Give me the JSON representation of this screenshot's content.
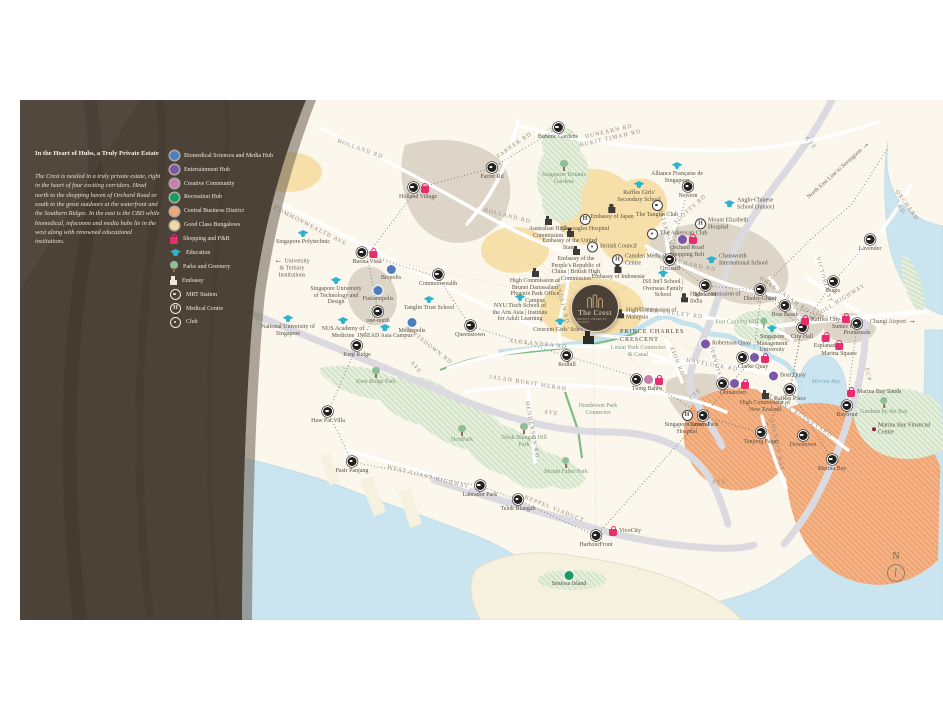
{
  "panel": {
    "title": "In the Heart of Hubs, a Truly Private Estate",
    "body": "The Crest is nestled in a truly private estate, right in the heart of four exciting corridors. Head north to the shopping haven of Orchard Road or south to the great outdoors at the waterfront and the Southern Ridges. In the east is the CBD while biomedical, infocomm and media hubs lie in the west along with renowned educational institutions.",
    "legend": [
      {
        "type": "hub-biomedical",
        "label": "Biomedical Sciences and Media Hub"
      },
      {
        "type": "hub-entertainment",
        "label": "Entertainment Hub"
      },
      {
        "type": "hub-creative",
        "label": "Creative Community"
      },
      {
        "type": "hub-recreation",
        "label": "Recreation Hub"
      },
      {
        "type": "hub-cbd",
        "label": "Central Business District"
      },
      {
        "type": "hub-gcb",
        "label": "Good Class Bungalows"
      },
      {
        "type": "shopping",
        "label": "Shopping and F&B"
      },
      {
        "type": "education",
        "label": "Education"
      },
      {
        "type": "park",
        "label": "Parks and Greenery"
      },
      {
        "type": "embassy",
        "label": "Embassy"
      },
      {
        "type": "mrt",
        "label": "MRT Station"
      },
      {
        "type": "medical",
        "label": "Medical Centre"
      },
      {
        "type": "club",
        "label": "Club"
      }
    ]
  },
  "crest": {
    "name": "The Crest",
    "tagline": "AT PRINCE CHARLES CRESCENT",
    "road": "PRINCE CHARLES\nCRESCENT"
  },
  "compass": {
    "label": "N"
  },
  "map": {
    "points": [
      {
        "x": 472,
        "y": 68,
        "icons": [
          "mrt"
        ],
        "label": "Farrer Rd"
      },
      {
        "x": 538,
        "y": 28,
        "icons": [
          "mrt"
        ],
        "label": "Botanic Gardens"
      },
      {
        "x": 668,
        "y": 87,
        "icons": [
          "mrt"
        ],
        "label": "Newton"
      },
      {
        "x": 398,
        "y": 88,
        "icons": [
          "mrt",
          "shopping"
        ],
        "label": "Holland Village"
      },
      {
        "x": 347,
        "y": 153,
        "icons": [
          "mrt",
          "shopping"
        ],
        "label": "Buona Vista"
      },
      {
        "x": 418,
        "y": 175,
        "icons": [
          "mrt"
        ],
        "label": "Commonwealth"
      },
      {
        "x": 358,
        "y": 212,
        "icons": [
          "mrt"
        ],
        "label": "one-north"
      },
      {
        "x": 337,
        "y": 246,
        "icons": [
          "mrt"
        ],
        "label": "Kent Ridge"
      },
      {
        "x": 308,
        "y": 312,
        "icons": [
          "mrt"
        ],
        "label": "Haw Par Villa"
      },
      {
        "x": 450,
        "y": 226,
        "icons": [
          "mrt"
        ],
        "label": "Queenstown"
      },
      {
        "x": 547,
        "y": 256,
        "icons": [
          "mrt"
        ],
        "label": "Redhill"
      },
      {
        "x": 627,
        "y": 280,
        "icons": [
          "mrt",
          "hub-creative",
          "shopping"
        ],
        "label": "Tiong Bahru"
      },
      {
        "x": 332,
        "y": 362,
        "icons": [
          "mrt"
        ],
        "label": "Pasir Panjang"
      },
      {
        "x": 460,
        "y": 386,
        "icons": [
          "mrt"
        ],
        "label": "Labrador Park"
      },
      {
        "x": 498,
        "y": 400,
        "icons": [
          "mrt"
        ],
        "label": "Telok Blangah"
      },
      {
        "x": 576,
        "y": 436,
        "icons": [
          "mrt"
        ],
        "label": "HarbourFront"
      },
      {
        "x": 594,
        "y": 431,
        "icons": [
          "shopping"
        ],
        "label": "VivoCity",
        "side": "r"
      },
      {
        "x": 650,
        "y": 160,
        "icons": [
          "mrt"
        ],
        "label": "Orchard"
      },
      {
        "x": 685,
        "y": 186,
        "icons": [
          "mrt"
        ],
        "label": "Somerset"
      },
      {
        "x": 740,
        "y": 190,
        "icons": [
          "mrt"
        ],
        "label": "Dhoby Ghaut"
      },
      {
        "x": 765,
        "y": 206,
        "icons": [
          "mrt"
        ],
        "label": "Bras Basah"
      },
      {
        "x": 813,
        "y": 182,
        "icons": [
          "mrt"
        ],
        "label": "Bugis"
      },
      {
        "x": 782,
        "y": 228,
        "icons": [
          "mrt"
        ],
        "label": "City Hall"
      },
      {
        "x": 837,
        "y": 224,
        "icons": [
          "mrt"
        ],
        "label": "Promenade"
      },
      {
        "x": 806,
        "y": 238,
        "icons": [
          "shopping"
        ],
        "label": "Esplanade"
      },
      {
        "x": 786,
        "y": 220,
        "icons": [
          "shopping"
        ],
        "label": "Raffles City",
        "side": "r"
      },
      {
        "x": 826,
        "y": 219,
        "icons": [
          "shopping"
        ],
        "label": "Suntec City"
      },
      {
        "x": 819,
        "y": 246,
        "icons": [
          "shopping"
        ],
        "label": "Marina Square"
      },
      {
        "x": 832,
        "y": 292,
        "icons": [
          "shopping"
        ],
        "label": "Marina Bay Sands",
        "side": "r"
      },
      {
        "x": 827,
        "y": 306,
        "icons": [
          "mrt"
        ],
        "label": "Bayfront"
      },
      {
        "x": 770,
        "y": 290,
        "icons": [
          "mrt"
        ],
        "label": "Raffles Place"
      },
      {
        "x": 783,
        "y": 336,
        "icons": [
          "mrt"
        ],
        "label": "Downtown"
      },
      {
        "x": 812,
        "y": 360,
        "icons": [
          "mrt"
        ],
        "label": "Marina Bay"
      },
      {
        "x": 741,
        "y": 333,
        "icons": [
          "mrt"
        ],
        "label": "Tanjong Pagar"
      },
      {
        "x": 683,
        "y": 316,
        "icons": [
          "mrt"
        ],
        "label": "Outram Park"
      },
      {
        "x": 713,
        "y": 284,
        "icons": [
          "mrt",
          "hub-entertainment",
          "shopping"
        ],
        "label": "Chinatown"
      },
      {
        "x": 733,
        "y": 258,
        "icons": [
          "mrt",
          "hub-entertainment",
          "shopping"
        ],
        "label": "Clarke Quay"
      },
      {
        "x": 850,
        "y": 140,
        "icons": [
          "mrt"
        ],
        "label": "Lavender"
      },
      {
        "x": 686,
        "y": 244,
        "icons": [
          "hub-entertainment"
        ],
        "label": "Robertson Quay",
        "side": "r"
      },
      {
        "x": 754,
        "y": 276,
        "icons": [
          "hub-entertainment"
        ],
        "label": "Boat Quay",
        "side": "r"
      },
      {
        "x": 667,
        "y": 140,
        "icons": [
          "hub-entertainment",
          "shopping"
        ],
        "label": "Orchard Road Shopping Belt"
      },
      {
        "x": 371,
        "y": 171,
        "icons": [
          "hub-biomedical"
        ],
        "label": "Biopolis"
      },
      {
        "x": 358,
        "y": 192,
        "icons": [
          "hub-biomedical"
        ],
        "label": "Fusionopolis"
      },
      {
        "x": 392,
        "y": 224,
        "icons": [
          "hub-biomedical"
        ],
        "label": "Mediapolis"
      },
      {
        "x": 549,
        "y": 477,
        "icons": [
          "hub-recreation"
        ],
        "label": "Sentosa Island"
      },
      {
        "x": 283,
        "y": 136,
        "icons": [
          "education"
        ],
        "label": "Singapore Polytechnic"
      },
      {
        "x": 316,
        "y": 183,
        "icons": [
          "education"
        ],
        "label": "Singapore University of Technology and Design"
      },
      {
        "x": 268,
        "y": 221,
        "icons": [
          "education"
        ],
        "label": "National University of Singapore"
      },
      {
        "x": 323,
        "y": 223,
        "icons": [
          "education"
        ],
        "label": "NUS Academy of Medicine"
      },
      {
        "x": 365,
        "y": 230,
        "icons": [
          "education"
        ],
        "label": "INSEAD Asia Campus"
      },
      {
        "x": 409,
        "y": 202,
        "icons": [
          "education"
        ],
        "label": "Tanglin Trust School"
      },
      {
        "x": 540,
        "y": 224,
        "icons": [
          "education"
        ],
        "label": "Crescent Girls' School"
      },
      {
        "x": 500,
        "y": 200,
        "icons": [
          "education"
        ],
        "label": "NYU Tisch School of the Arts Asia | Institute for Adult Learning"
      },
      {
        "x": 619,
        "y": 87,
        "icons": [
          "education"
        ],
        "label": "Raffles Girls' Secondary School"
      },
      {
        "x": 657,
        "y": 68,
        "icons": [
          "education"
        ],
        "label": "Alliance Française de Singapour"
      },
      {
        "x": 709,
        "y": 104,
        "icons": [
          "education"
        ],
        "label": "Anglo-Chinese School (Junior)",
        "side": "r"
      },
      {
        "x": 691,
        "y": 160,
        "icons": [
          "education"
        ],
        "label": "Chatsworth International School",
        "side": "r"
      },
      {
        "x": 643,
        "y": 176,
        "icons": [
          "education"
        ],
        "label": "ISS Int'l School | Overseas Family School"
      },
      {
        "x": 752,
        "y": 231,
        "icons": [
          "education"
        ],
        "label": "Singapore Management University"
      },
      {
        "x": 565,
        "y": 120,
        "icons": [
          "medical"
        ],
        "label": "Gleneagles Hospital"
      },
      {
        "x": 597,
        "y": 160,
        "icons": [
          "medical"
        ],
        "label": "Camden Medical Centre",
        "side": "r"
      },
      {
        "x": 680,
        "y": 124,
        "icons": [
          "medical"
        ],
        "label": "Mount Elizabeth Hospital",
        "side": "r"
      },
      {
        "x": 667,
        "y": 316,
        "icons": [
          "medical"
        ],
        "label": "Singapore General Hospital"
      },
      {
        "x": 637,
        "y": 106,
        "icons": [
          "club"
        ],
        "label": "The Tanglin Club"
      },
      {
        "x": 632,
        "y": 134,
        "icons": [
          "club"
        ],
        "label": "The American Club",
        "side": "r"
      },
      {
        "x": 572,
        "y": 147,
        "icons": [
          "club"
        ],
        "label": "British Council",
        "side": "r"
      },
      {
        "x": 528,
        "y": 122,
        "icons": [
          "embassy"
        ],
        "label": "Australian High Commission"
      },
      {
        "x": 550,
        "y": 134,
        "icons": [
          "embassy"
        ],
        "label": "Embassy of the United States"
      },
      {
        "x": 592,
        "y": 110,
        "icons": [
          "embassy"
        ],
        "label": "Embassy of Japan"
      },
      {
        "x": 556,
        "y": 152,
        "icons": [
          "embassy"
        ],
        "label": "Embassy of the People's Republic of China | British High Commission"
      },
      {
        "x": 515,
        "y": 174,
        "icons": [
          "embassy"
        ],
        "label": "High Commission of Brunei Darussalam"
      },
      {
        "x": 598,
        "y": 170,
        "icons": [
          "embassy"
        ],
        "label": "Embassy of Indonesia"
      },
      {
        "x": 666,
        "y": 198,
        "icons": [
          "embassy"
        ],
        "label": "High Commission of India",
        "side": "r"
      },
      {
        "x": 602,
        "y": 214,
        "icons": [
          "embassy"
        ],
        "label": "High Commission of Malaysia",
        "side": "r"
      },
      {
        "x": 745,
        "y": 296,
        "icons": [
          "embassy"
        ],
        "label": "High Commission of New Zealand"
      },
      {
        "x": 544,
        "y": 66,
        "icons": [
          "park"
        ],
        "label": "Singapore Botanic Gardens",
        "cls": "park"
      },
      {
        "x": 356,
        "y": 273,
        "icons": [
          "park"
        ],
        "label": "Kent Ridge Park",
        "cls": "park"
      },
      {
        "x": 442,
        "y": 331,
        "icons": [
          "park"
        ],
        "label": "HortPark",
        "cls": "park"
      },
      {
        "x": 504,
        "y": 329,
        "icons": [
          "park"
        ],
        "label": "Telok Blangah Hill Park",
        "cls": "park"
      },
      {
        "x": 546,
        "y": 363,
        "icons": [
          "park"
        ],
        "label": "Mount Faber Park",
        "cls": "park"
      },
      {
        "x": 743,
        "y": 223,
        "icons": [
          "park"
        ],
        "label": "Fort Canning Hill",
        "side": "l",
        "cls": "park"
      },
      {
        "x": 864,
        "y": 303,
        "icons": [
          "park"
        ],
        "label": "Gardens by the Bay",
        "cls": "park"
      },
      {
        "x": 857,
        "y": 329,
        "icons": [
          "poi"
        ],
        "label": "Marina Bay Financial Centre",
        "side": "r"
      },
      {
        "x": 515,
        "y": 196,
        "icons": [],
        "label": "Phoenix Park Office Campus"
      },
      {
        "x": 578,
        "y": 308,
        "icons": [],
        "label": "Henderson Park Connector",
        "cls": "park"
      },
      {
        "x": 618,
        "y": 250,
        "icons": [],
        "label": "Linear Park Connector & Canal",
        "cls": "park"
      },
      {
        "x": 806,
        "y": 284,
        "icons": [],
        "label": "Marina Bay",
        "cls": "water"
      }
    ],
    "roads": [
      {
        "x": 590,
        "y": 36,
        "r": -13,
        "label": "DUNEARN RD\nBUKIT TIMAH RD"
      },
      {
        "x": 495,
        "y": 46,
        "r": -35,
        "label": "FARRER RD"
      },
      {
        "x": 340,
        "y": 50,
        "r": 20,
        "label": "HOLLAND RD"
      },
      {
        "x": 487,
        "y": 117,
        "r": 14,
        "label": "HOLLAND RD"
      },
      {
        "x": 290,
        "y": 127,
        "r": 27,
        "label": "COMMONWEALTH AVE"
      },
      {
        "x": 408,
        "y": 246,
        "r": 38,
        "label": "PORTSDOWN RD"
      },
      {
        "x": 395,
        "y": 268,
        "r": 52,
        "label": "AYE"
      },
      {
        "x": 531,
        "y": 314,
        "r": 8,
        "label": "AYE"
      },
      {
        "x": 699,
        "y": 383,
        "r": 0,
        "label": "AYE"
      },
      {
        "x": 541,
        "y": 202,
        "r": 76,
        "label": "TANGLIN RD"
      },
      {
        "x": 646,
        "y": 134,
        "r": 74,
        "label": "PATERSON RD"
      },
      {
        "x": 671,
        "y": 110,
        "r": -42,
        "label": "SCOTTS RD"
      },
      {
        "x": 672,
        "y": 166,
        "r": 12,
        "label": "ORCHARD RD"
      },
      {
        "x": 883,
        "y": 108,
        "r": 55,
        "label": "ORCHARD RD"
      },
      {
        "x": 650,
        "y": 214,
        "r": 7,
        "label": "RIVER VALLEY RD"
      },
      {
        "x": 518,
        "y": 245,
        "r": 6,
        "label": "ALEXANDRA RD"
      },
      {
        "x": 508,
        "y": 284,
        "r": 9,
        "label": "JALAN BUKIT MERAH"
      },
      {
        "x": 511,
        "y": 330,
        "r": 80,
        "label": "HENDERSON RD"
      },
      {
        "x": 656,
        "y": 262,
        "r": 68,
        "label": "ZION RD"
      },
      {
        "x": 692,
        "y": 266,
        "r": 10,
        "label": "HAVELOCK RD"
      },
      {
        "x": 696,
        "y": 268,
        "r": 74,
        "label": "JERVOIS RD"
      },
      {
        "x": 790,
        "y": 44,
        "r": 50,
        "label": "CTE"
      },
      {
        "x": 676,
        "y": 295,
        "r": -45,
        "label": "CTE"
      },
      {
        "x": 847,
        "y": 275,
        "r": 80,
        "label": "ECP"
      },
      {
        "x": 534,
        "y": 410,
        "r": 22,
        "label": "KEPPEL VIADUCT"
      },
      {
        "x": 408,
        "y": 378,
        "r": 14,
        "label": "WEST COAST HIGHWAY"
      },
      {
        "x": 818,
        "y": 203,
        "r": -32,
        "label": "NICOLL HIGHWAY"
      },
      {
        "x": 803,
        "y": 180,
        "r": 74,
        "label": "VICTORIA ST"
      },
      {
        "x": 764,
        "y": 196,
        "r": 35,
        "label": "BRAS BASAH RD"
      },
      {
        "x": 756,
        "y": 346,
        "r": 78,
        "label": "SHENTON WAY"
      },
      {
        "x": 779,
        "y": 316,
        "r": 33,
        "label": "MARINA BOULEVARD"
      }
    ],
    "annotations": [
      {
        "x": 272,
        "y": 168,
        "r": 0,
        "arrow": "l",
        "label": "University\n& Tertiary\nInstitutions"
      },
      {
        "x": 818,
        "y": 70,
        "r": -42,
        "arrow": "r",
        "label": "North East Line to Serangoon"
      },
      {
        "x": 873,
        "y": 221,
        "r": 0,
        "arrow": "r",
        "label": "Changi Airport"
      }
    ]
  },
  "colors": {
    "map-bg": "#FBF7EC",
    "water": "#CBE5F0",
    "panel": "#4D4237",
    "label": "#5A5245",
    "road-label": "#948B7D",
    "shopping": "#E72D6D",
    "education": "#2EB3CE",
    "park-leaf": "#8FBF96",
    "park-trunk": "#8B7157",
    "embassy": "#3C3B37",
    "biomedical": "#4D7FBE",
    "entertainment": "#7B57A5",
    "creative": "#C97FAE",
    "recreation": "#169B62",
    "cbd": "#F0A878",
    "gcb": "#F2DCA6",
    "crest-bg": "#4C4136",
    "crest-gold": "#E9DFC9"
  }
}
